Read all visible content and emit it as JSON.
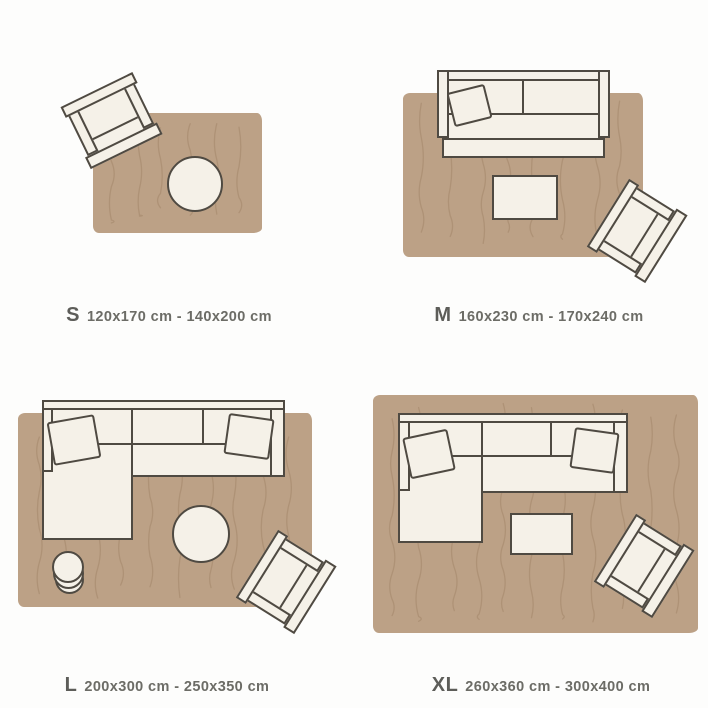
{
  "sizes": [
    {
      "id": "S",
      "letter": "S",
      "range": "120x170 cm - 140x200 cm"
    },
    {
      "id": "M",
      "letter": "M",
      "range": "160x230 cm - 170x240 cm"
    },
    {
      "id": "L",
      "letter": "L",
      "range": "200x300 cm - 250x350 cm"
    },
    {
      "id": "XL",
      "letter": "XL",
      "range": "260x360 cm - 300x400 cm"
    }
  ],
  "colors": {
    "background": "#fdfdfc",
    "rug": "#bca186",
    "rug_texture_line": "#9d8163",
    "furniture_fill": "#f5f1e8",
    "furniture_outline": "#4f4a42",
    "label_letter": "#5d5d59",
    "label_text": "#6c6c66"
  },
  "scenes": {
    "S": {
      "rug_shape": "rectangle",
      "furniture": [
        "armchair",
        "round-side-table"
      ]
    },
    "M": {
      "rug_shape": "rectangle",
      "furniture": [
        "sofa-with-pillow",
        "coffee-table",
        "armchair"
      ]
    },
    "L": {
      "rug_shape": "rectangle",
      "furniture": [
        "sectional-sofa-with-pillows",
        "round-coffee-table",
        "stacked-side-table",
        "armchair"
      ]
    },
    "XL": {
      "rug_shape": "rectangle",
      "furniture": [
        "sectional-sofa-with-pillows",
        "coffee-table",
        "armchair"
      ]
    }
  }
}
